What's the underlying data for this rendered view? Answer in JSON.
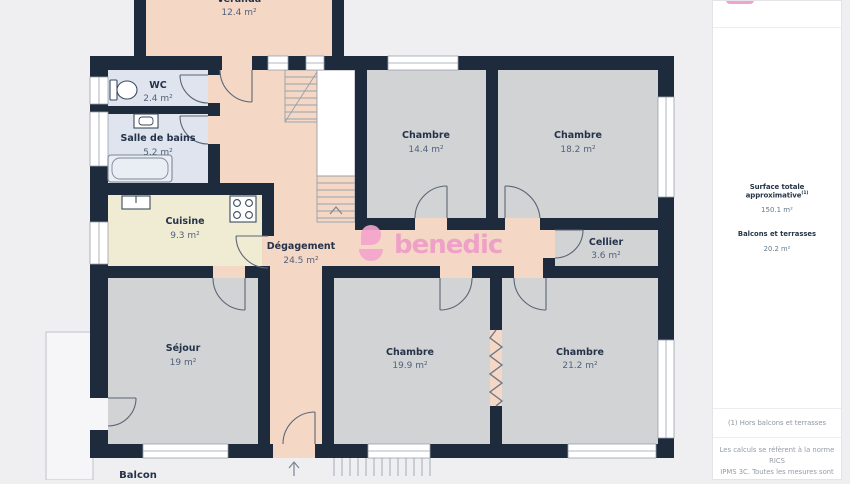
{
  "plan": {
    "rooms": [
      {
        "name": "Véranda",
        "area": "12.4 m²"
      },
      {
        "name": "WC",
        "area": "2.4 m²"
      },
      {
        "name": "Salle de bains",
        "area": "5.2 m²"
      },
      {
        "name": "Cuisine",
        "area": "9.3 m²"
      },
      {
        "name": "Dégagement",
        "area": "24.5 m²"
      },
      {
        "name": "Chambre",
        "area": "14.4 m²"
      },
      {
        "name": "Chambre",
        "area": "18.2 m²"
      },
      {
        "name": "Cellier",
        "area": "3.6 m²"
      },
      {
        "name": "Séjour",
        "area": "19 m²"
      },
      {
        "name": "Chambre",
        "area": "19.9 m²"
      },
      {
        "name": "Chambre",
        "area": "21.2 m²"
      },
      {
        "name": "Balcon",
        "area": ""
      }
    ],
    "watermark": "benedic"
  },
  "sidebar": {
    "surface_title": "Surface totale approximative",
    "surface_ref": "(1)",
    "surface_value": "150.1 m²",
    "balconies_title": "Balcons et terrasses",
    "balconies_value": "20.2 m²",
    "footnote": "(1) Hors balcons et terrasses",
    "disclaimer_1": "Les calculs se réfèrent à la norme RICS",
    "disclaimer_2": "IPMS 3C. Toutes les mesures sont"
  },
  "colors": {
    "wall": "#1e2b3c",
    "circulation": "#f4d7c5",
    "room_gray": "#d2d3d5",
    "bath_blue": "#dfe4ee",
    "kitchen_cream": "#f0ebd3",
    "brand_pink": "#ee9ac7"
  }
}
